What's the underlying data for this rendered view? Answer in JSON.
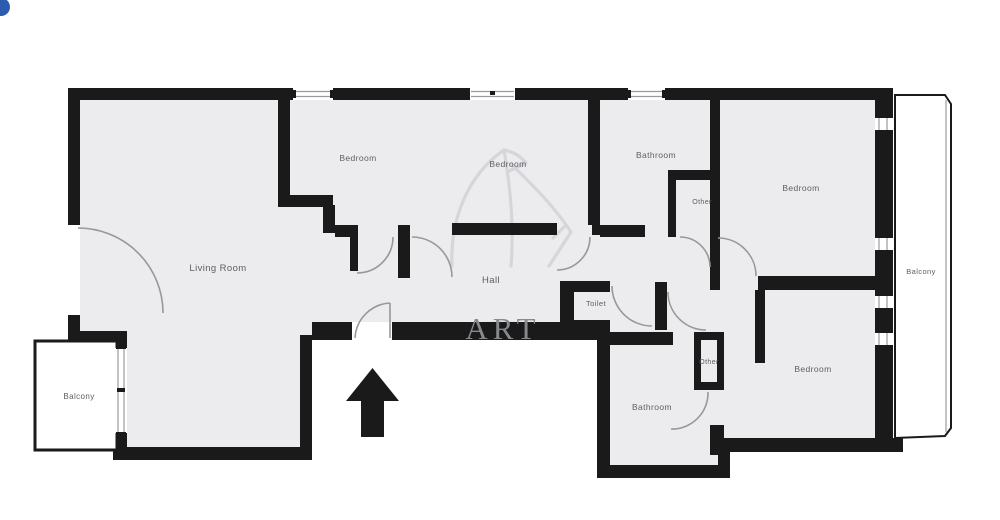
{
  "plan_title": "Apartment floor plan",
  "rooms": {
    "living_room": "Living Room",
    "bedroom_top_left": "Bedroom",
    "bedroom_top_middle": "Bedroom",
    "bathroom_top": "Bathroom",
    "other_top": "Other",
    "bedroom_right": "Bedroom",
    "hall": "Hall",
    "toilet": "Toilet",
    "other_bottom": "Other",
    "bathroom_bottom": "Bathroom",
    "bedroom_bottom_right": "Bedroom",
    "balcony_left": "Balcony",
    "balcony_right": "Balcony"
  },
  "watermark": {
    "text": "ART"
  },
  "icons": {
    "entrance_arrow": "up-arrow",
    "corner_badge": "blue-dot"
  },
  "colors": {
    "background": "#ffffff",
    "floor": "#ececef",
    "wall": "#1a1a1a",
    "door_arc": "#989898",
    "label": "#5d5f63",
    "window_line": "#9b9b9b",
    "balcony_border": "#1a1a1a",
    "watermark_line": "#d4d6da",
    "watermark_text": "#87898d",
    "accent_dot": "#2b5cb0"
  }
}
